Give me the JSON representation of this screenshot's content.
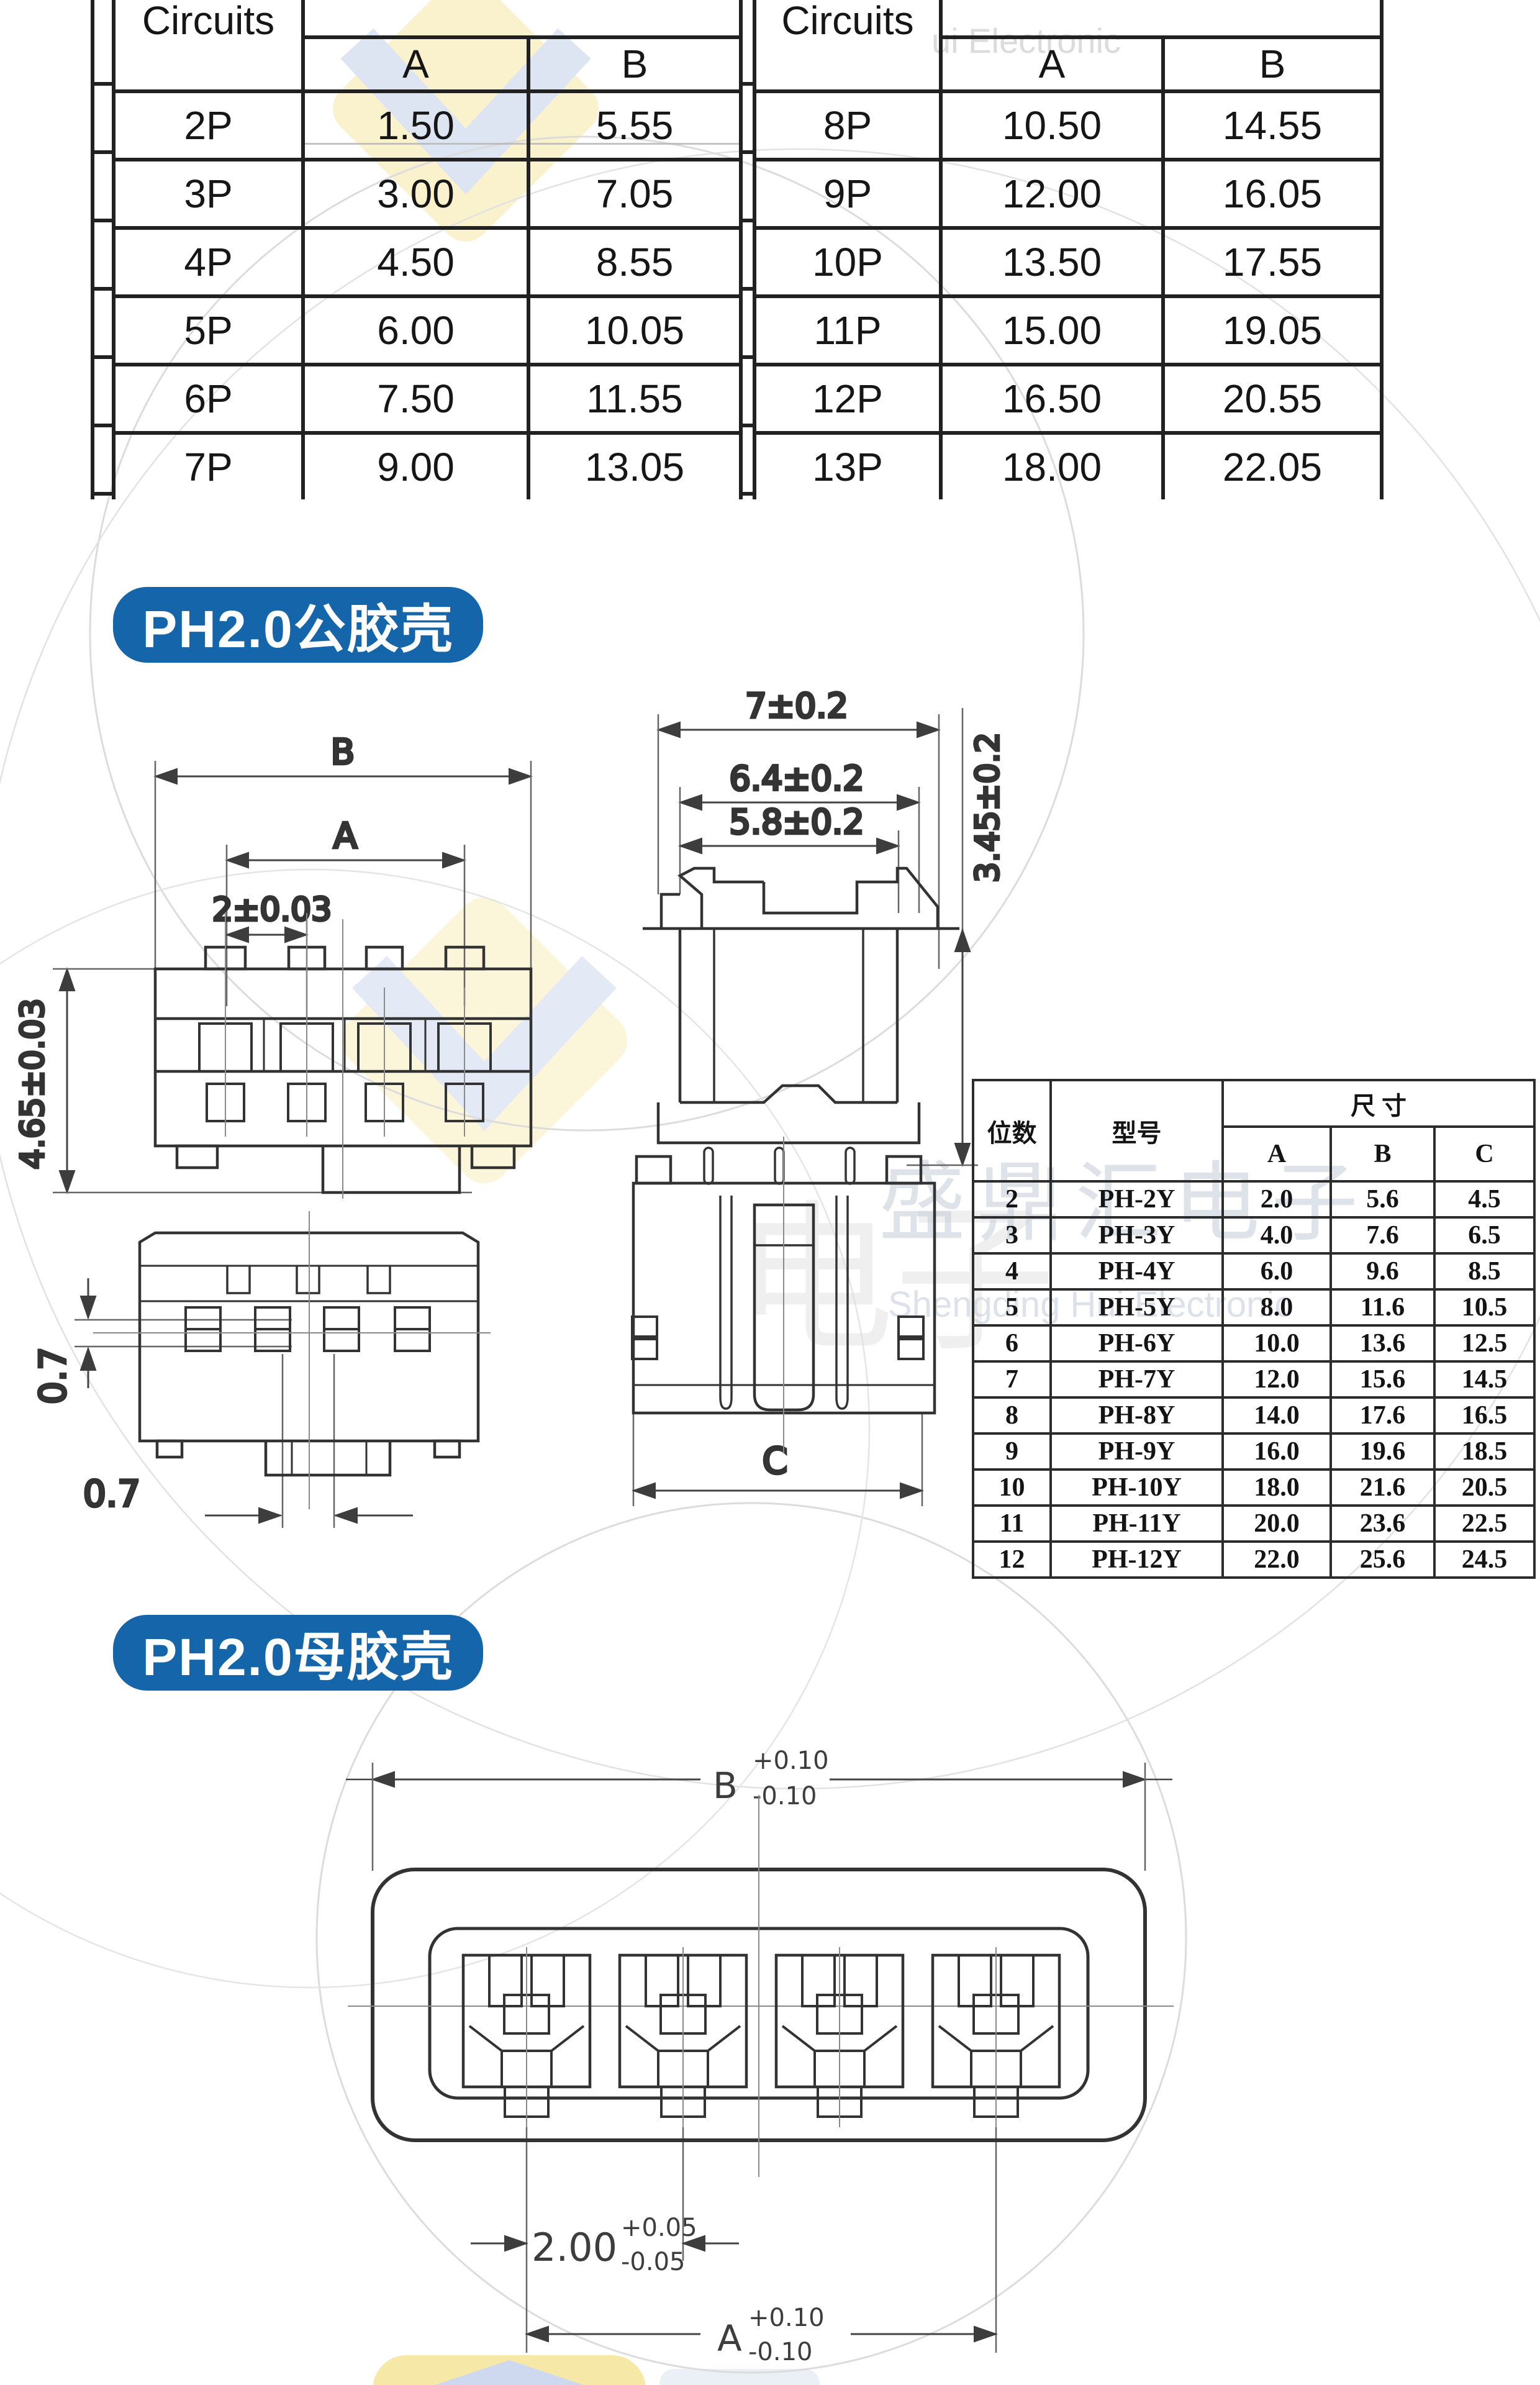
{
  "colors": {
    "badge_bg": "#1565ab",
    "table_line": "#212121",
    "drawing_line": "#333333",
    "watermark_yellow": "#faf1cd",
    "watermark_blue": "#dde4f2"
  },
  "pitch_tables": {
    "left": {
      "header": {
        "circuits": "Circuits",
        "a": "A",
        "b": "B"
      },
      "rows": [
        [
          "2P",
          "1.50",
          "5.55"
        ],
        [
          "3P",
          "3.00",
          "7.05"
        ],
        [
          "4P",
          "4.50",
          "8.55"
        ],
        [
          "5P",
          "6.00",
          "10.05"
        ],
        [
          "6P",
          "7.50",
          "11.55"
        ],
        [
          "7P",
          "9.00",
          "13.05"
        ]
      ]
    },
    "right": {
      "header": {
        "circuits": "Circuits",
        "a": "A",
        "b": "B"
      },
      "rows": [
        [
          "8P",
          "10.50",
          "14.55"
        ],
        [
          "9P",
          "12.00",
          "16.05"
        ],
        [
          "10P",
          "13.50",
          "17.55"
        ],
        [
          "11P",
          "15.00",
          "19.05"
        ],
        [
          "12P",
          "16.50",
          "20.55"
        ],
        [
          "13P",
          "18.00",
          "22.05"
        ]
      ]
    }
  },
  "male_section": {
    "badge": "PH2.0公胶壳",
    "front_view": {
      "dim_b": "B",
      "dim_a": "A",
      "dim_pitch": "2±0.03",
      "dim_height": "4.65±0.03"
    },
    "side_view": {
      "dim_w1": "7±0.2",
      "dim_w2": "6.4±0.2",
      "dim_w3": "5.8±0.2",
      "dim_h": "3.45±0.2"
    },
    "bottom_view": {
      "dim_v": "0.7",
      "dim_h": "0.7"
    },
    "top_view": {
      "dim_c": "C"
    },
    "spec_table": {
      "header": {
        "positions": "位数",
        "model": "型号",
        "size": "尺 寸",
        "a": "A",
        "b": "B",
        "c": "C"
      },
      "rows": [
        [
          "2",
          "PH-2Y",
          "2.0",
          "5.6",
          "4.5"
        ],
        [
          "3",
          "PH-3Y",
          "4.0",
          "7.6",
          "6.5"
        ],
        [
          "4",
          "PH-4Y",
          "6.0",
          "9.6",
          "8.5"
        ],
        [
          "5",
          "PH-5Y",
          "8.0",
          "11.6",
          "10.5"
        ],
        [
          "6",
          "PH-6Y",
          "10.0",
          "13.6",
          "12.5"
        ],
        [
          "7",
          "PH-7Y",
          "12.0",
          "15.6",
          "14.5"
        ],
        [
          "8",
          "PH-8Y",
          "14.0",
          "17.6",
          "16.5"
        ],
        [
          "9",
          "PH-9Y",
          "16.0",
          "19.6",
          "18.5"
        ],
        [
          "10",
          "PH-10Y",
          "18.0",
          "21.6",
          "20.5"
        ],
        [
          "11",
          "PH-11Y",
          "20.0",
          "23.6",
          "22.5"
        ],
        [
          "12",
          "PH-12Y",
          "22.0",
          "25.6",
          "24.5"
        ]
      ]
    }
  },
  "female_section": {
    "badge": "PH2.0母胶壳",
    "dim_b": "B",
    "tol_b_plus": "+0.10",
    "tol_b_minus": "-0.10",
    "dim_pitch": "2.00",
    "tol_pitch_plus": "+0.05",
    "tol_pitch_minus": "-0.05",
    "dim_a": "A",
    "tol_a_plus": "+0.10",
    "tol_a_minus": "-0.10"
  },
  "watermark": {
    "cn": "盛鼎汇电子",
    "en": "Shengding Hui Electronic",
    "en_top": "ui Electronic",
    "cn_big": "电子"
  }
}
